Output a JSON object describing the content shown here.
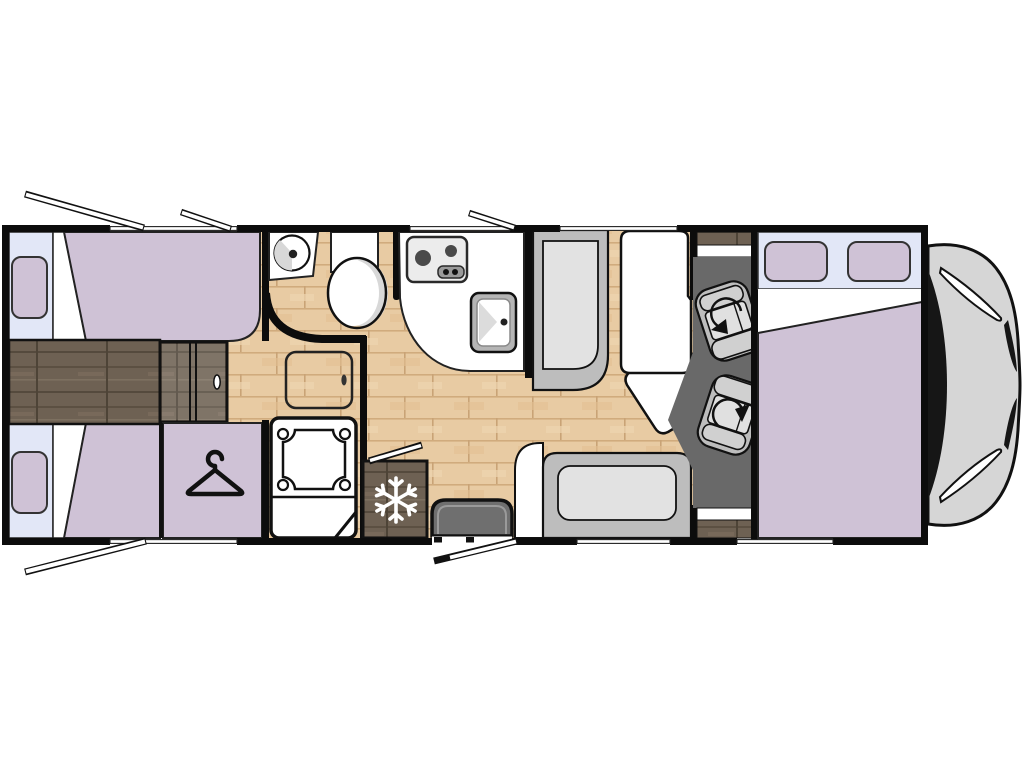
{
  "meta": {
    "title": "Motorhome floor plan (top view)",
    "view": "top-down",
    "vehicle_front": "right",
    "visible_text": ""
  },
  "colors": {
    "wall": "#0c0c0c",
    "bed_purple": "#cfc2d6",
    "pillow_purple": "#cbbDD3",
    "bed_headboard_blue": "#e2e7f7",
    "wood_light": "#e8cba3",
    "wood_light_line": "#d0ab7d",
    "wood_dark": "#6e6153",
    "wood_dark_line": "#5c5042",
    "seat_gray": "#bdbdbd",
    "cushion_gray": "#e2e2e2",
    "cab_floor_gray": "#696969",
    "step_gray": "#6f6f6f",
    "hood_gray": "#d6d6d6",
    "fixture_white": "#ffffff",
    "shade_gray": "#d8d8d8"
  },
  "icons": {
    "wardrobe": "hanger-icon",
    "fridge": "snowflake-icon",
    "cab_seats": "rotate-arrow-icon",
    "stove": "two-burner-hob-icon",
    "kitchen_sink": "sink-icon",
    "washbasin": "round-basin-icon",
    "toilet": "toilet-icon",
    "shower": "shower-tray-icon"
  },
  "features": {
    "rooms": [
      "rear-twin-bedroom",
      "wardrobe",
      "washroom",
      "shower",
      "kitchen",
      "dinette",
      "cab",
      "overcab-drop-down-bed"
    ],
    "bed_count": 3,
    "pillow_count": 4,
    "cab_seat_count": 2,
    "stove_burner_count": 2,
    "open_windows": 4,
    "open_doors": 2
  }
}
